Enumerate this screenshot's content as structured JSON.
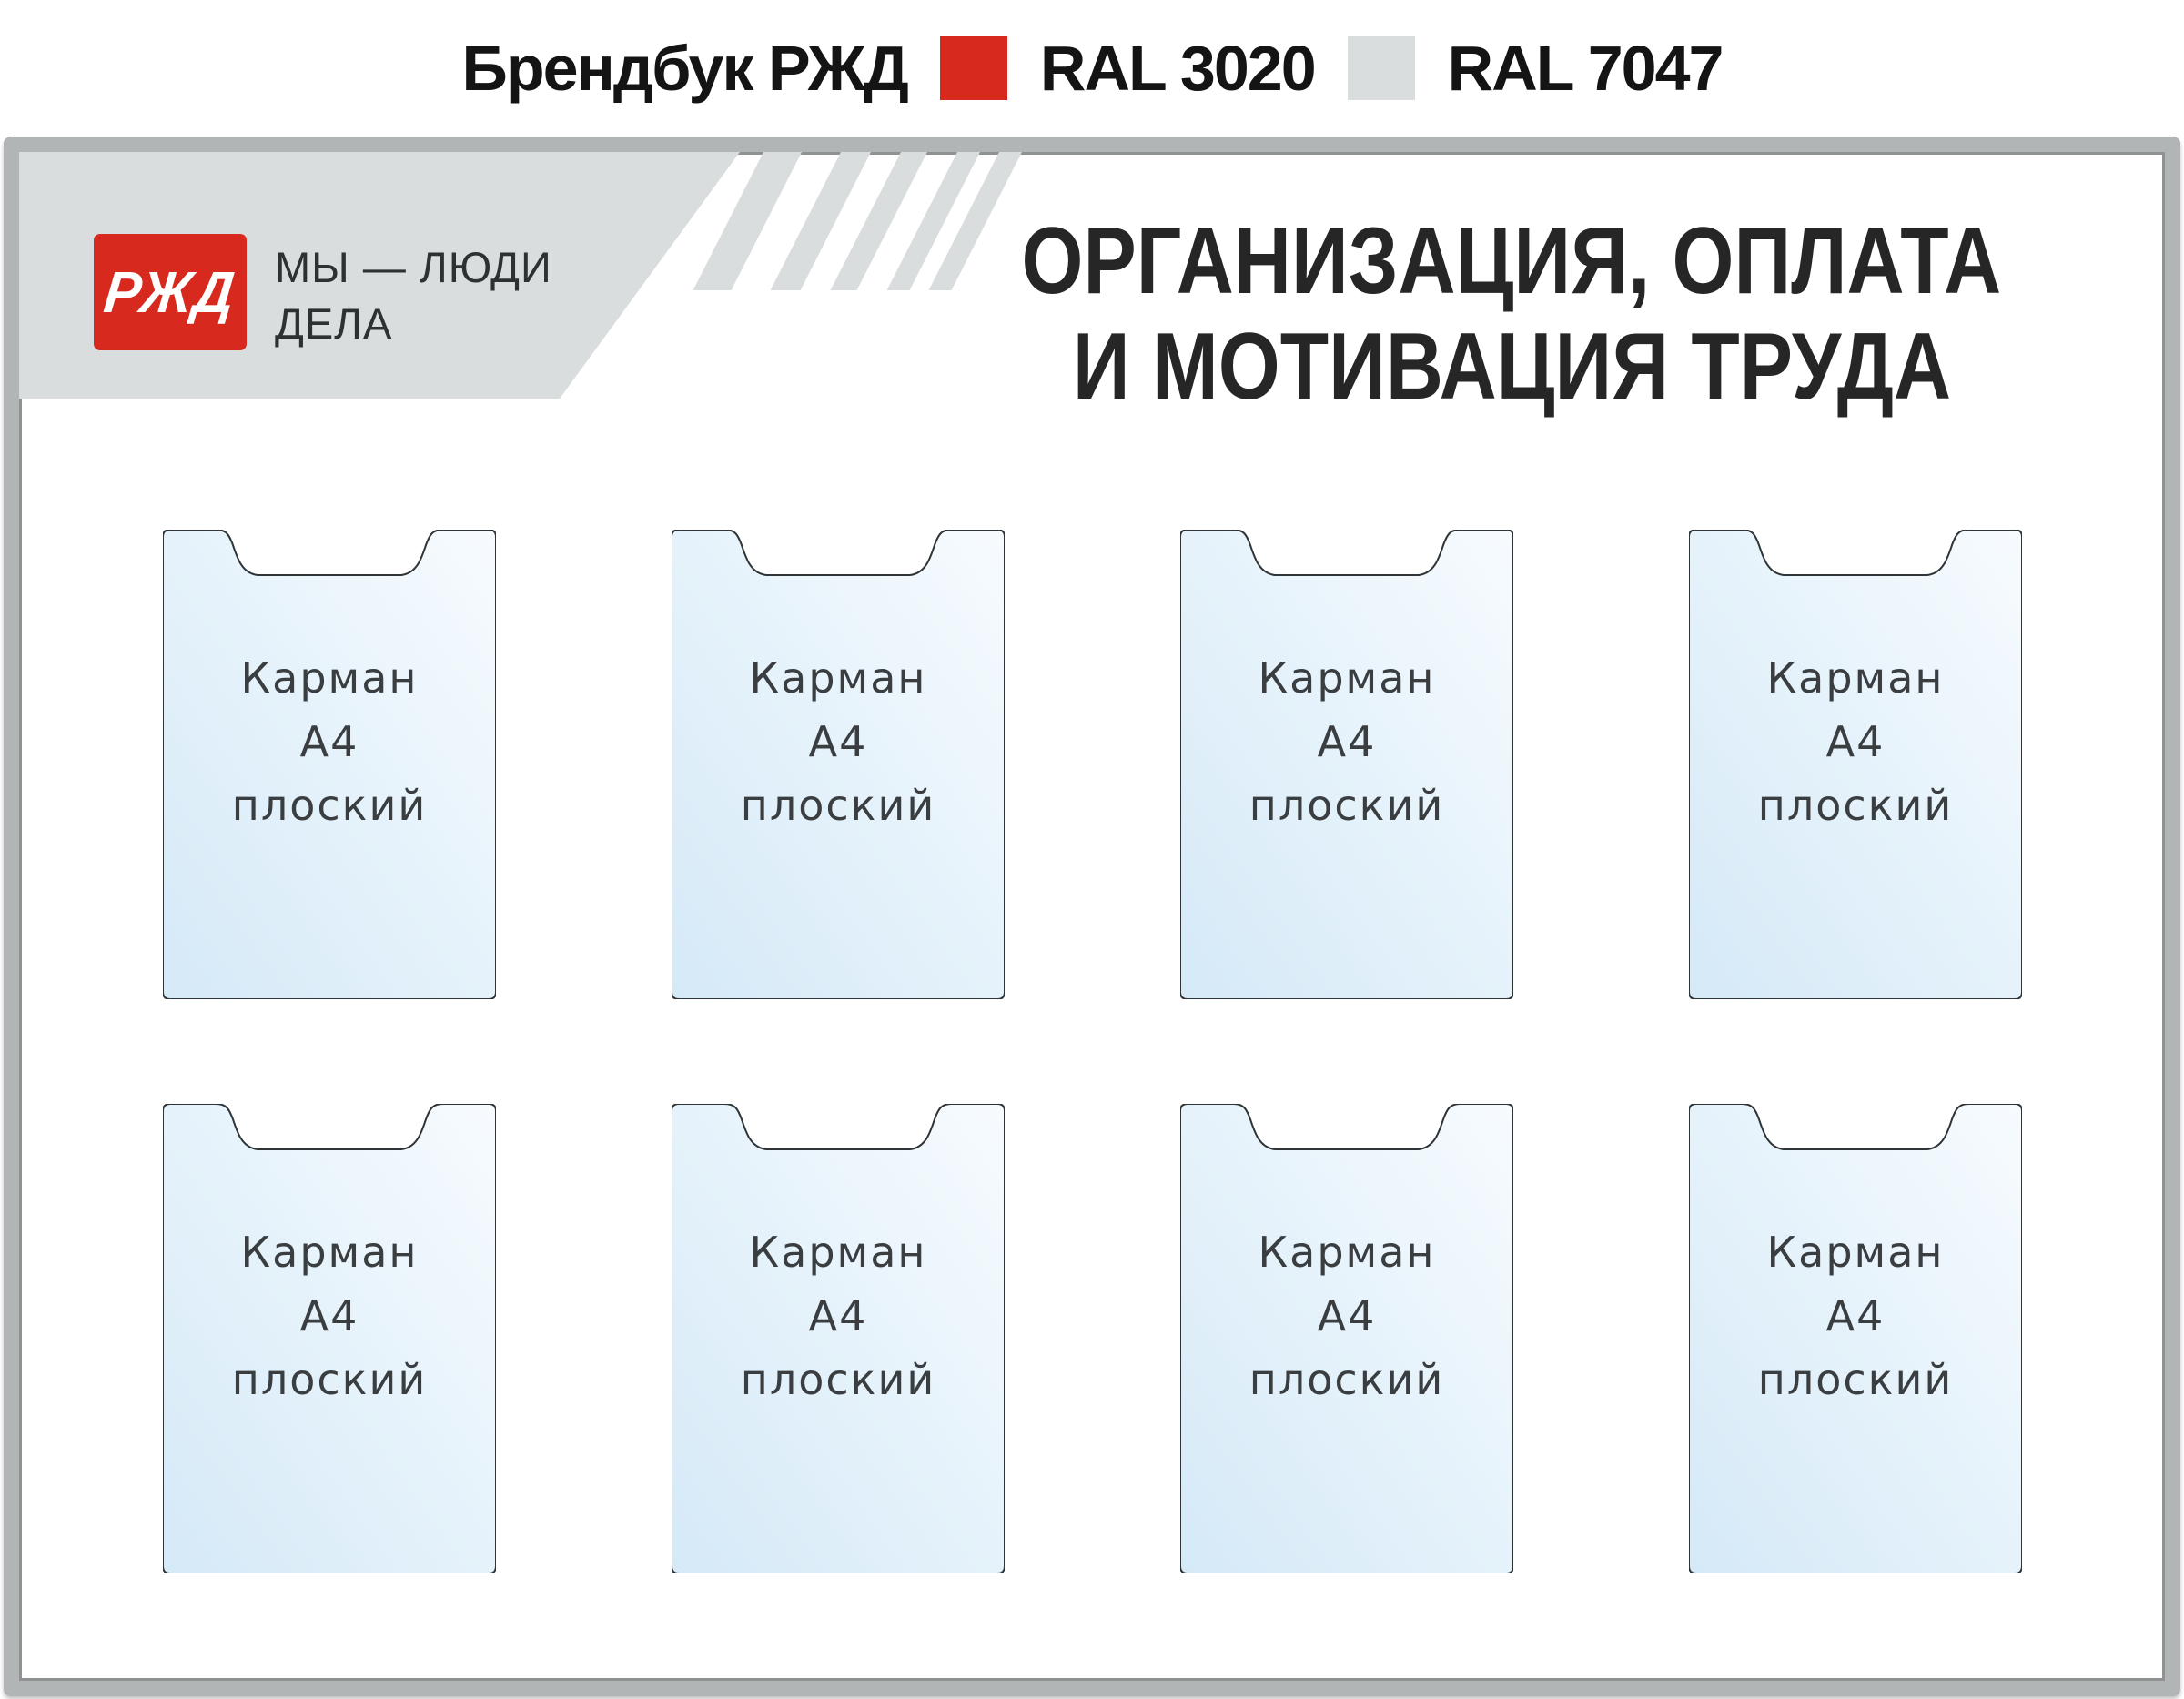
{
  "header": {
    "brand": "Брендбук РЖД",
    "swatches": [
      {
        "label": "RAL 3020",
        "color": "#d8291e"
      },
      {
        "label": "RAL 7047",
        "color": "#d9dddd"
      }
    ]
  },
  "colors": {
    "ral3020": "#d8291e",
    "ral7047": "#d9dddd",
    "pocket_outline": "#2f3437",
    "frame_gray": "#b2b5b5",
    "title_text": "#262626"
  },
  "board": {
    "logo": {
      "text": "РЖД"
    },
    "slogan": {
      "line1": "МЫ — ЛЮДИ",
      "line2": "ДЕЛА"
    },
    "title": {
      "line1": "ОРГАНИЗАЦИЯ, ОПЛАТА",
      "line2": "И МОТИВАЦИЯ ТРУДА"
    },
    "pockets": [
      {
        "line1": "Карман",
        "line2": "А4",
        "line3": "плоский"
      },
      {
        "line1": "Карман",
        "line2": "А4",
        "line3": "плоский"
      },
      {
        "line1": "Карман",
        "line2": "А4",
        "line3": "плоский"
      },
      {
        "line1": "Карман",
        "line2": "А4",
        "line3": "плоский"
      },
      {
        "line1": "Карман",
        "line2": "А4",
        "line3": "плоский"
      },
      {
        "line1": "Карман",
        "line2": "А4",
        "line3": "плоский"
      },
      {
        "line1": "Карман",
        "line2": "А4",
        "line3": "плоский"
      },
      {
        "line1": "Карман",
        "line2": "А4",
        "line3": "плоский"
      }
    ]
  }
}
